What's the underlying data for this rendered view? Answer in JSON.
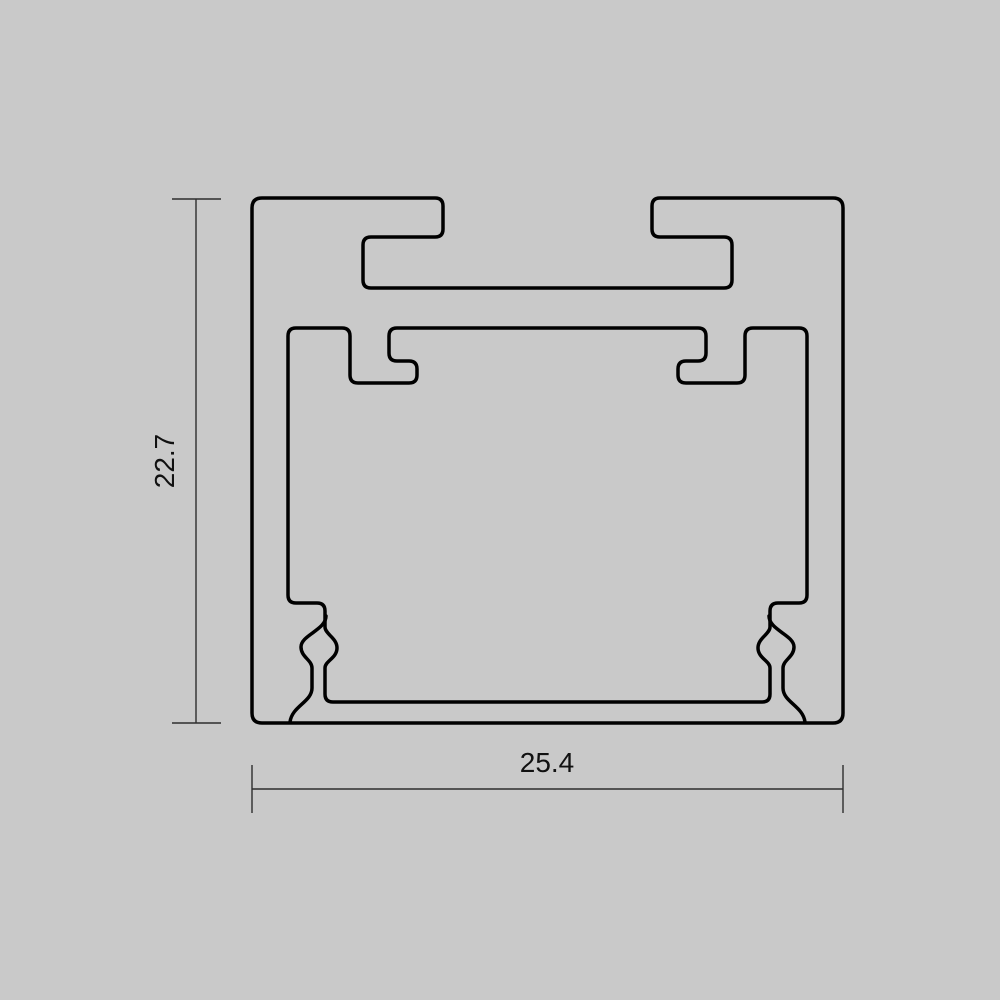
{
  "page": {
    "background": "#c9c9c9"
  },
  "drawing": {
    "profile_line_color": "#000000",
    "profile_line_width": 3.5,
    "dimension_line_color": "#2e2e2e",
    "dimension_line_width": 1.4,
    "label_color": "#111111",
    "dimensions": {
      "height": {
        "label": "22.7"
      },
      "width": {
        "label": "25.4"
      }
    }
  }
}
